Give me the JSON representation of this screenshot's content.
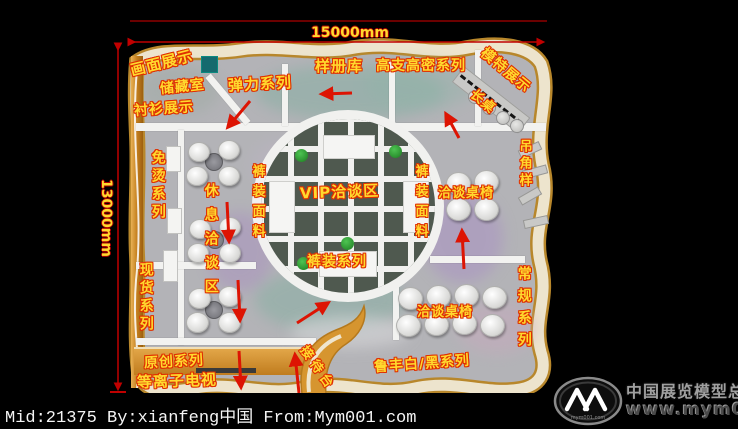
{
  "dimensions": {
    "width_label": "15000mm",
    "height_label": "13000mm"
  },
  "labels": {
    "pic_display": "画面展示",
    "storage": "储藏室",
    "shirt_display": "衬衫展示",
    "stretch_series": "弹力系列",
    "sample_library": "样册库",
    "high_count_series": "高支高密系列",
    "model_display": "模特展示",
    "long_table": "长桌",
    "non_iron_series": "免烫系列",
    "rest_talk_area": "休息洽谈区",
    "pants_fabric_left": "裤装面料",
    "vip_area": "VIP洽谈区",
    "pants_fabric_right": "裤装面料",
    "talk_tables_right": "洽谈桌椅",
    "hanging_samples": "吊角样",
    "stock_series": "现货系列",
    "pants_series": "裤装系列",
    "regular_series": "常规系列",
    "talk_tables_bottom": "洽谈桌椅",
    "original_series": "原创系列",
    "plasma_tv": "等离子电视",
    "reception_desk": "接待台",
    "lufeng_series": "鲁丰白/黑系列"
  },
  "footer": {
    "credit": "Mid:21375 By:xianfeng中国 From:Mym001.com"
  },
  "watermark": {
    "site_name": "中国展览模型总网",
    "url": "www.mym001.com",
    "logo_subtext": "mym001.com"
  },
  "colors": {
    "label_fill": "#ffd92e",
    "label_outline": "#e03000",
    "arrow": "#dd1403",
    "dimension_line": "#c00000",
    "booth_border": "#b8872b",
    "wall": "#f2f2f0",
    "floor": "#b3b3b7",
    "lattice": "#4f594f",
    "desk": "#d6952f"
  }
}
